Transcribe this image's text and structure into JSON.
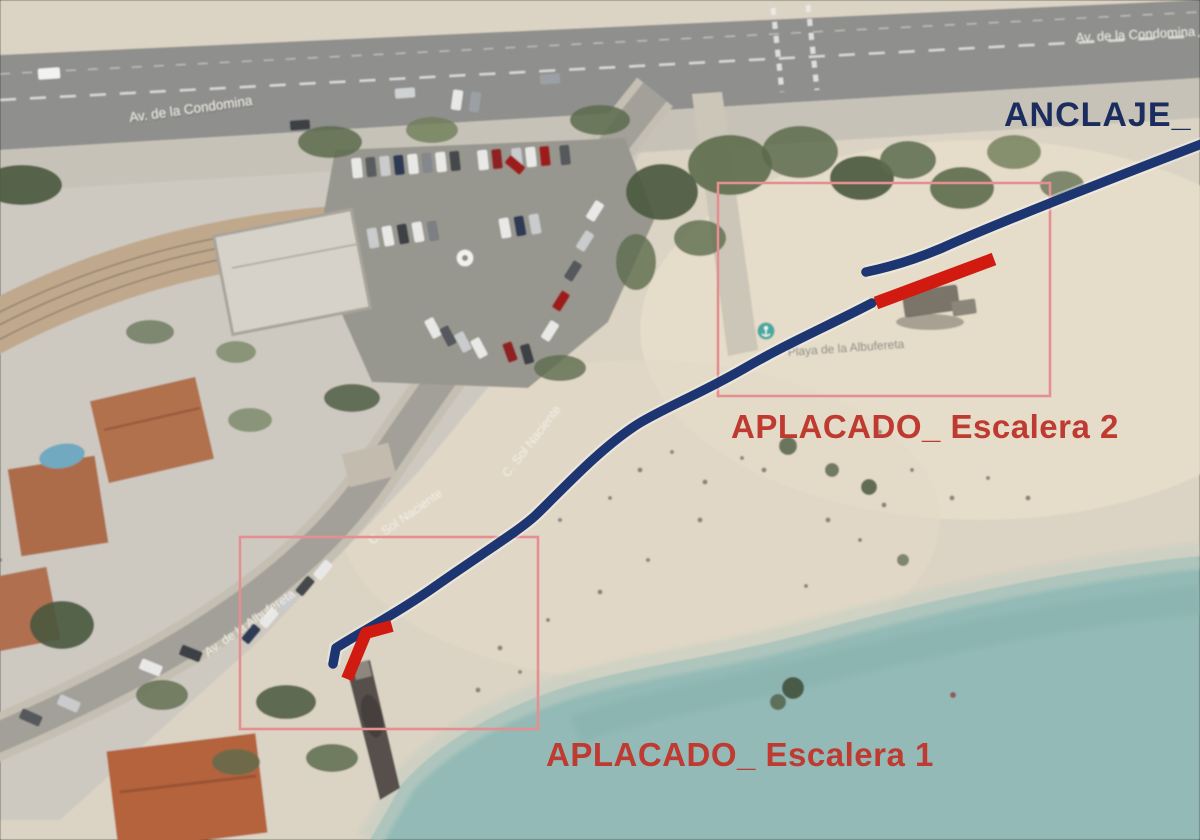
{
  "labels": {
    "anclaje": "ANCLAJE_",
    "escalera2": "APLACADO_ Escalera 2",
    "escalera1": "APLACADO_ Escalera 1"
  },
  "streets": {
    "condomina_left": "Av. de la Condomina",
    "condomina_right": "Av. de la Condomina",
    "sol_upper": "C. Sol Naciente",
    "sol_lower": "C. Sol Naciente",
    "albufereta": "Av. de la Albufereta",
    "beach_name": "Playa de la Albufereta"
  },
  "icons": {
    "beach_poi": "anchor-poi-icon",
    "parking_poi": "circle-poi-icon"
  },
  "colors": {
    "route_blue": "#1d3570",
    "bar_red": "#d11a10",
    "rect_stroke": "#e59090",
    "label_red": "#bf3a31",
    "label_navy": "#1b2c5e",
    "sea": "#93bab6",
    "sand": "#dbd3c3",
    "road": "#8f8f8d"
  }
}
